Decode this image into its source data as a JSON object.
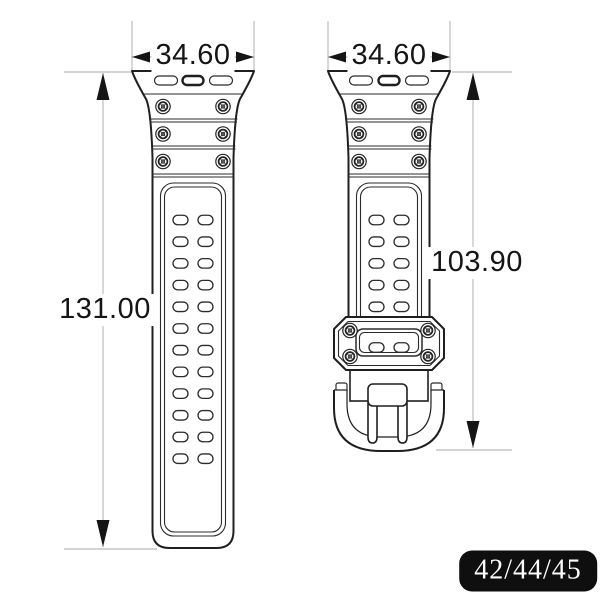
{
  "dimensions": {
    "left_width": "34.60",
    "right_width": "34.60",
    "left_length": "131.00",
    "right_length": "103.90"
  },
  "badge": {
    "text": "42/44/45"
  },
  "colors": {
    "background": "#ffffff",
    "outline": "#1f1f1f",
    "detail": "#2b2b2b",
    "dim_line": "#a8a8a8",
    "dim_text": "#151515",
    "badge_bg": "#0f0f0f",
    "badge_fg": "#ffffff"
  },
  "figure": {
    "hole_grids": [
      {
        "target": "left-holes",
        "rows": 12,
        "cols": 2,
        "start_y": 220,
        "step_y": 21.7,
        "center_x": 193,
        "col_offset": 12.5,
        "hole_w": 15,
        "hole_h": 9.5
      },
      {
        "target": "right-holes",
        "rows": 5,
        "cols": 2,
        "start_y": 220,
        "step_y": 21.7,
        "center_x": 389,
        "col_offset": 12.5,
        "hole_w": 15,
        "hole_h": 9.5
      },
      {
        "target": "keeper-holes",
        "rows": 1,
        "cols": 2,
        "start_y": 347.5,
        "step_y": 0,
        "center_x": 389,
        "col_offset": 12.5,
        "hole_w": 15,
        "hole_h": 9.5
      }
    ],
    "screw_sets": [
      {
        "target": "left-screws",
        "rows_y": [
          106.5,
          134,
          161.5
        ],
        "center_x": 193,
        "offset_x": 30
      },
      {
        "target": "right-screws",
        "rows_y": [
          106.5,
          134,
          161.5
        ],
        "center_x": 389,
        "offset_x": 30
      },
      {
        "target": "keeper-screws",
        "rows_y": [
          330.5,
          356.5
        ],
        "center_x": 389,
        "offset_x": 39
      }
    ]
  }
}
